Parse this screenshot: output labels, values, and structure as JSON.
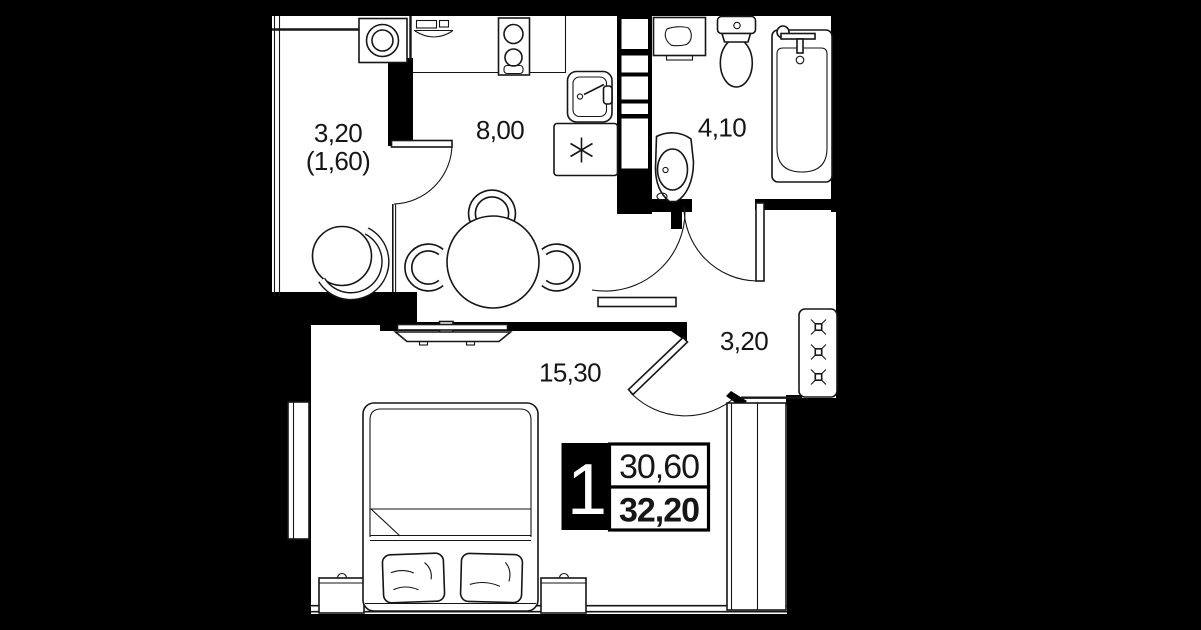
{
  "title": "1-room apartment floor plan",
  "colors": {
    "background": "#000000",
    "floor": "#ffffff",
    "line": "#161616"
  },
  "rooms": {
    "balcony": {
      "area": "3,20",
      "area_reduced": "(1,60)"
    },
    "kitchen": {
      "area": "8,00"
    },
    "bathroom": {
      "area": "4,10"
    },
    "hallway": {
      "area": "3,20"
    },
    "living_room": {
      "area": "15,30"
    }
  },
  "badge": {
    "room_count": "1",
    "area_top": "30,60",
    "area_bottom": "32,20"
  },
  "fixtures": [
    "washing-machine",
    "armchair",
    "dining-table",
    "chairs",
    "kitchen-counter",
    "cooktop",
    "kitchen-sink",
    "fridge",
    "ventilation-shaft",
    "vanity",
    "toilet",
    "bathtub",
    "washbasin",
    "coat-hangers-wardrobe",
    "tv",
    "bed",
    "pillows",
    "nightstands",
    "wardrobe",
    "windows",
    "doors"
  ]
}
